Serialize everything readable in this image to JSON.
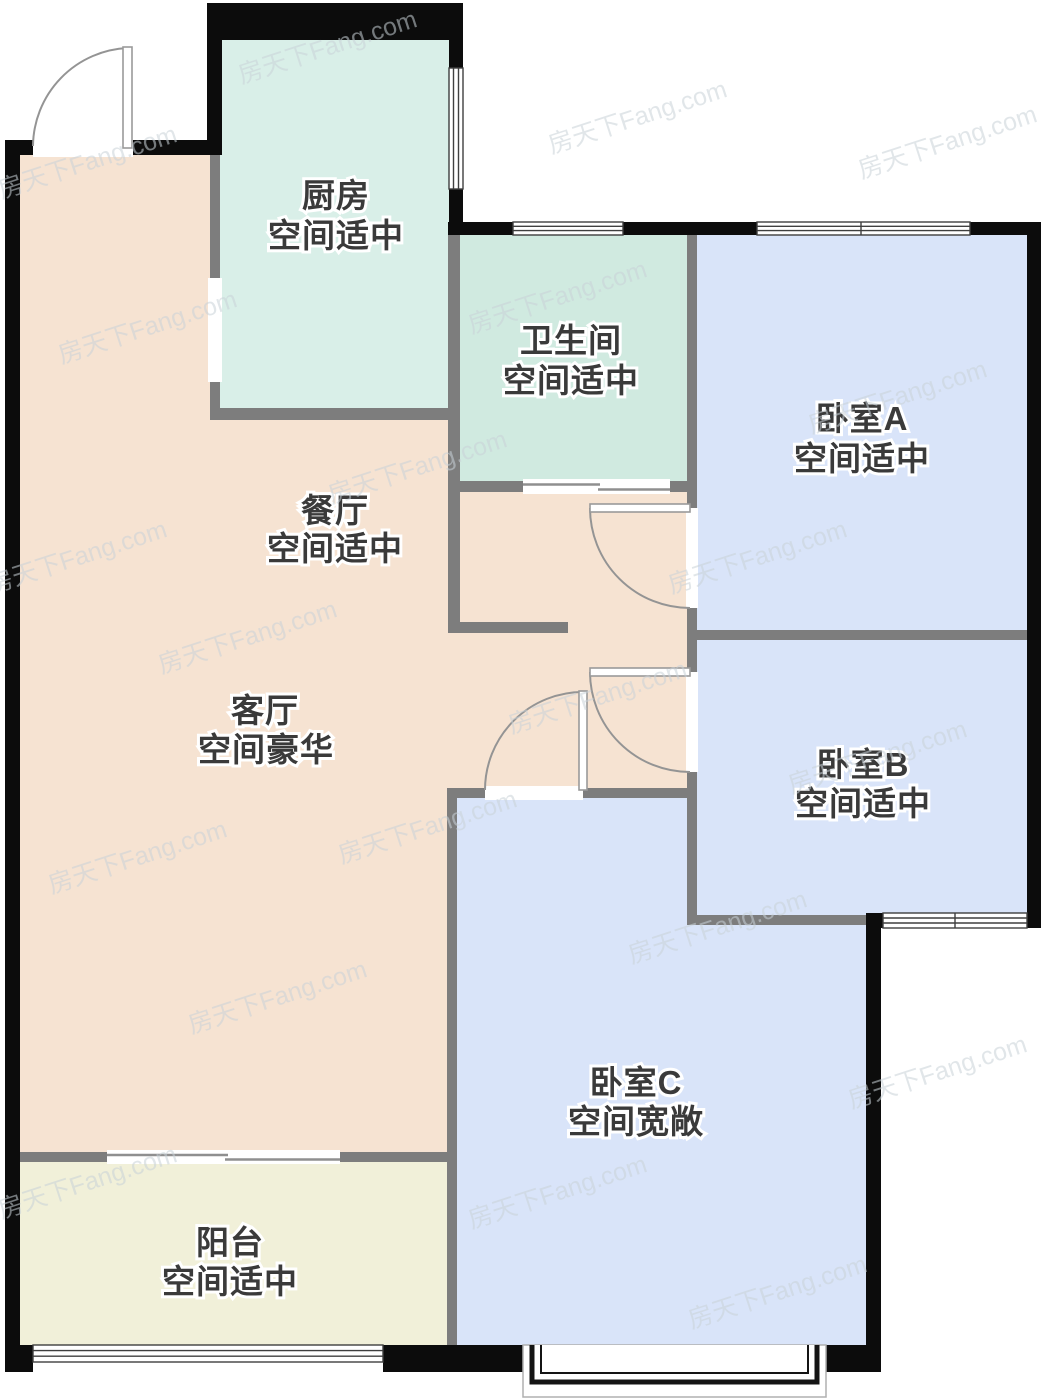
{
  "watermark": {
    "text": "房天下Fang.com"
  },
  "colors": {
    "kitchen": "#d9efe8",
    "bathroom": "#d0eae0",
    "bedroom": "#d9e4f9",
    "living": "#f6e3d2",
    "balcony": "#f1f0d9",
    "wall_exterior": "#0c0c0c",
    "wall_interior": "#7d7d7d",
    "label": "#3a3a3a"
  },
  "rooms": [
    {
      "id": "kitchen",
      "name": "厨房",
      "desc": "空间适中"
    },
    {
      "id": "bathroom",
      "name": "卫生间",
      "desc": "空间适中"
    },
    {
      "id": "bedroomA",
      "name": "卧室A",
      "desc": "空间适中"
    },
    {
      "id": "dining",
      "name": "餐厅",
      "desc": "空间适中"
    },
    {
      "id": "living",
      "name": "客厅",
      "desc": "空间豪华"
    },
    {
      "id": "bedroomB",
      "name": "卧室B",
      "desc": "空间适中"
    },
    {
      "id": "bedroomC",
      "name": "卧室C",
      "desc": "空间宽敞"
    },
    {
      "id": "balcony",
      "name": "阳台",
      "desc": "空间适中"
    }
  ]
}
